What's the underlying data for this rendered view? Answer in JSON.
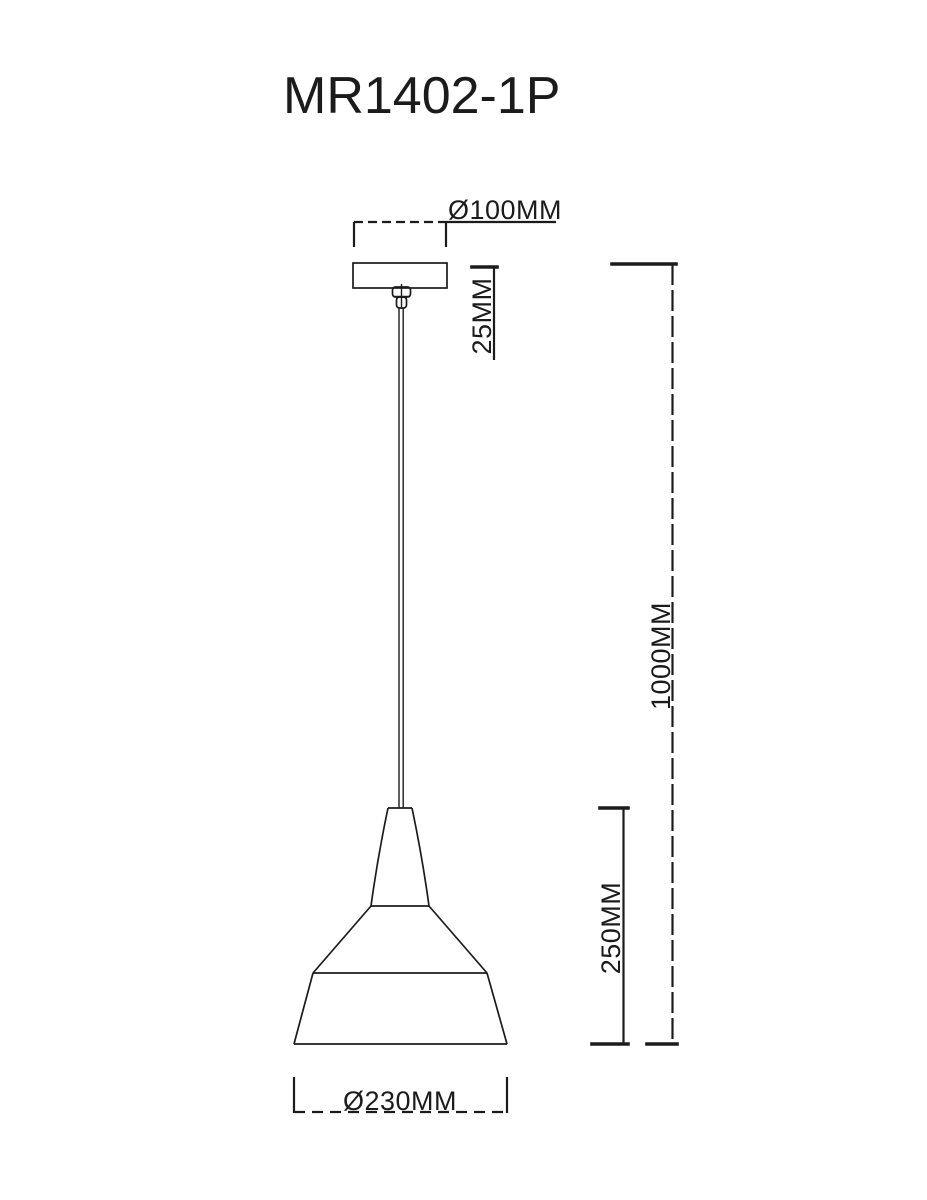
{
  "page": {
    "background_color": "#ffffff",
    "line_color": "#1b1b1b"
  },
  "drawing": {
    "title": "MR1402-1P",
    "type": "pendant-lamp-dimension-diagram",
    "dimensions": {
      "canopy_diameter": {
        "label": "Ø100MM",
        "value_mm": 100
      },
      "canopy_height": {
        "label": "25MM",
        "value_mm": 25
      },
      "overall_drop": {
        "label": "1000MM",
        "value_mm": 1000
      },
      "shade_height": {
        "label": "250MM",
        "value_mm": 250
      },
      "shade_diameter": {
        "label": "Ø230MM",
        "value_mm": 230
      }
    }
  }
}
